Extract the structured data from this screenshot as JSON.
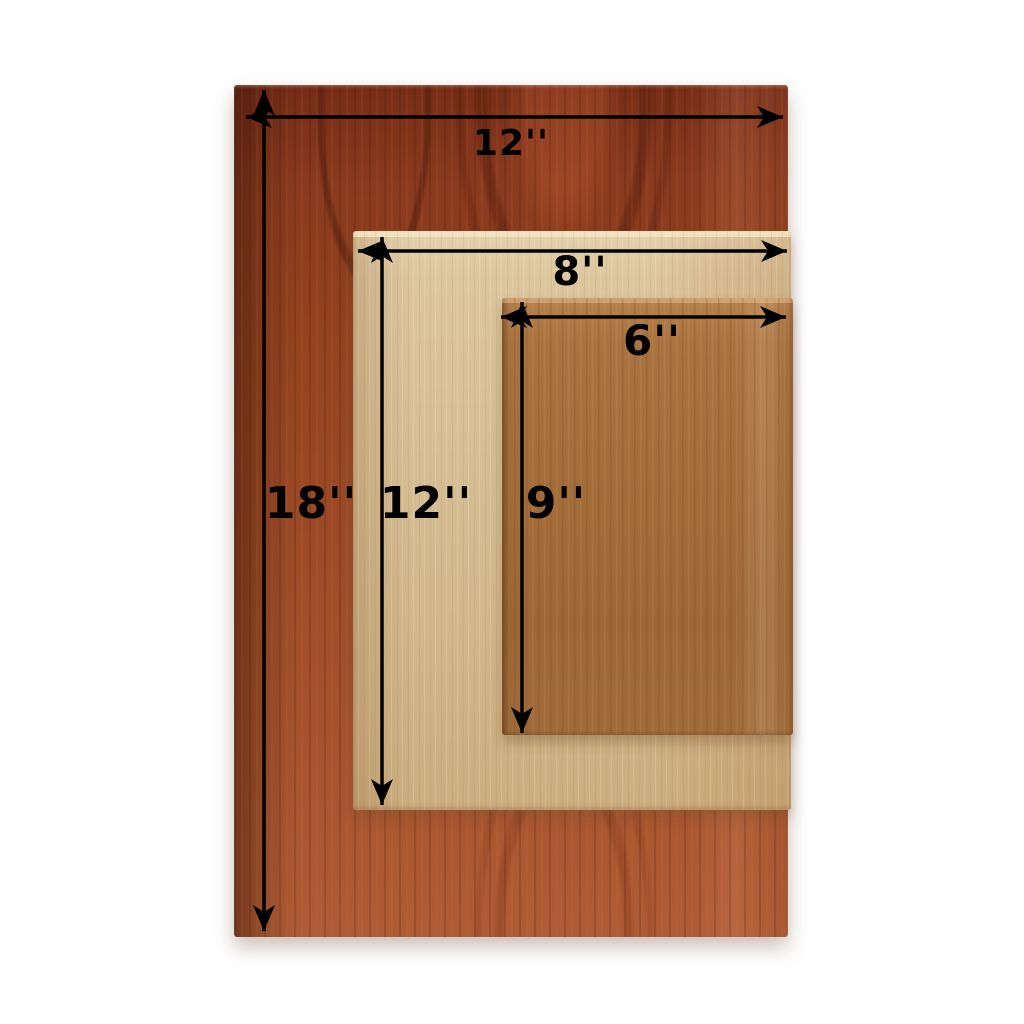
{
  "figure": {
    "background_color": "#ffffff",
    "annotation_color": "#000000"
  },
  "boards": [
    {
      "name": "large board",
      "width_in": 12,
      "height_in": 18,
      "width_label": "12''",
      "height_label": "18''",
      "wood_tone": "#9a4521"
    },
    {
      "name": "medium board",
      "width_in": 8,
      "height_in": 12,
      "width_label": "8''",
      "height_label": "12''",
      "wood_tone": "#d5bd92"
    },
    {
      "name": "small board",
      "width_in": 6,
      "height_in": 9,
      "width_label": "6''",
      "height_label": "9''",
      "wood_tone": "#a36c39"
    }
  ]
}
